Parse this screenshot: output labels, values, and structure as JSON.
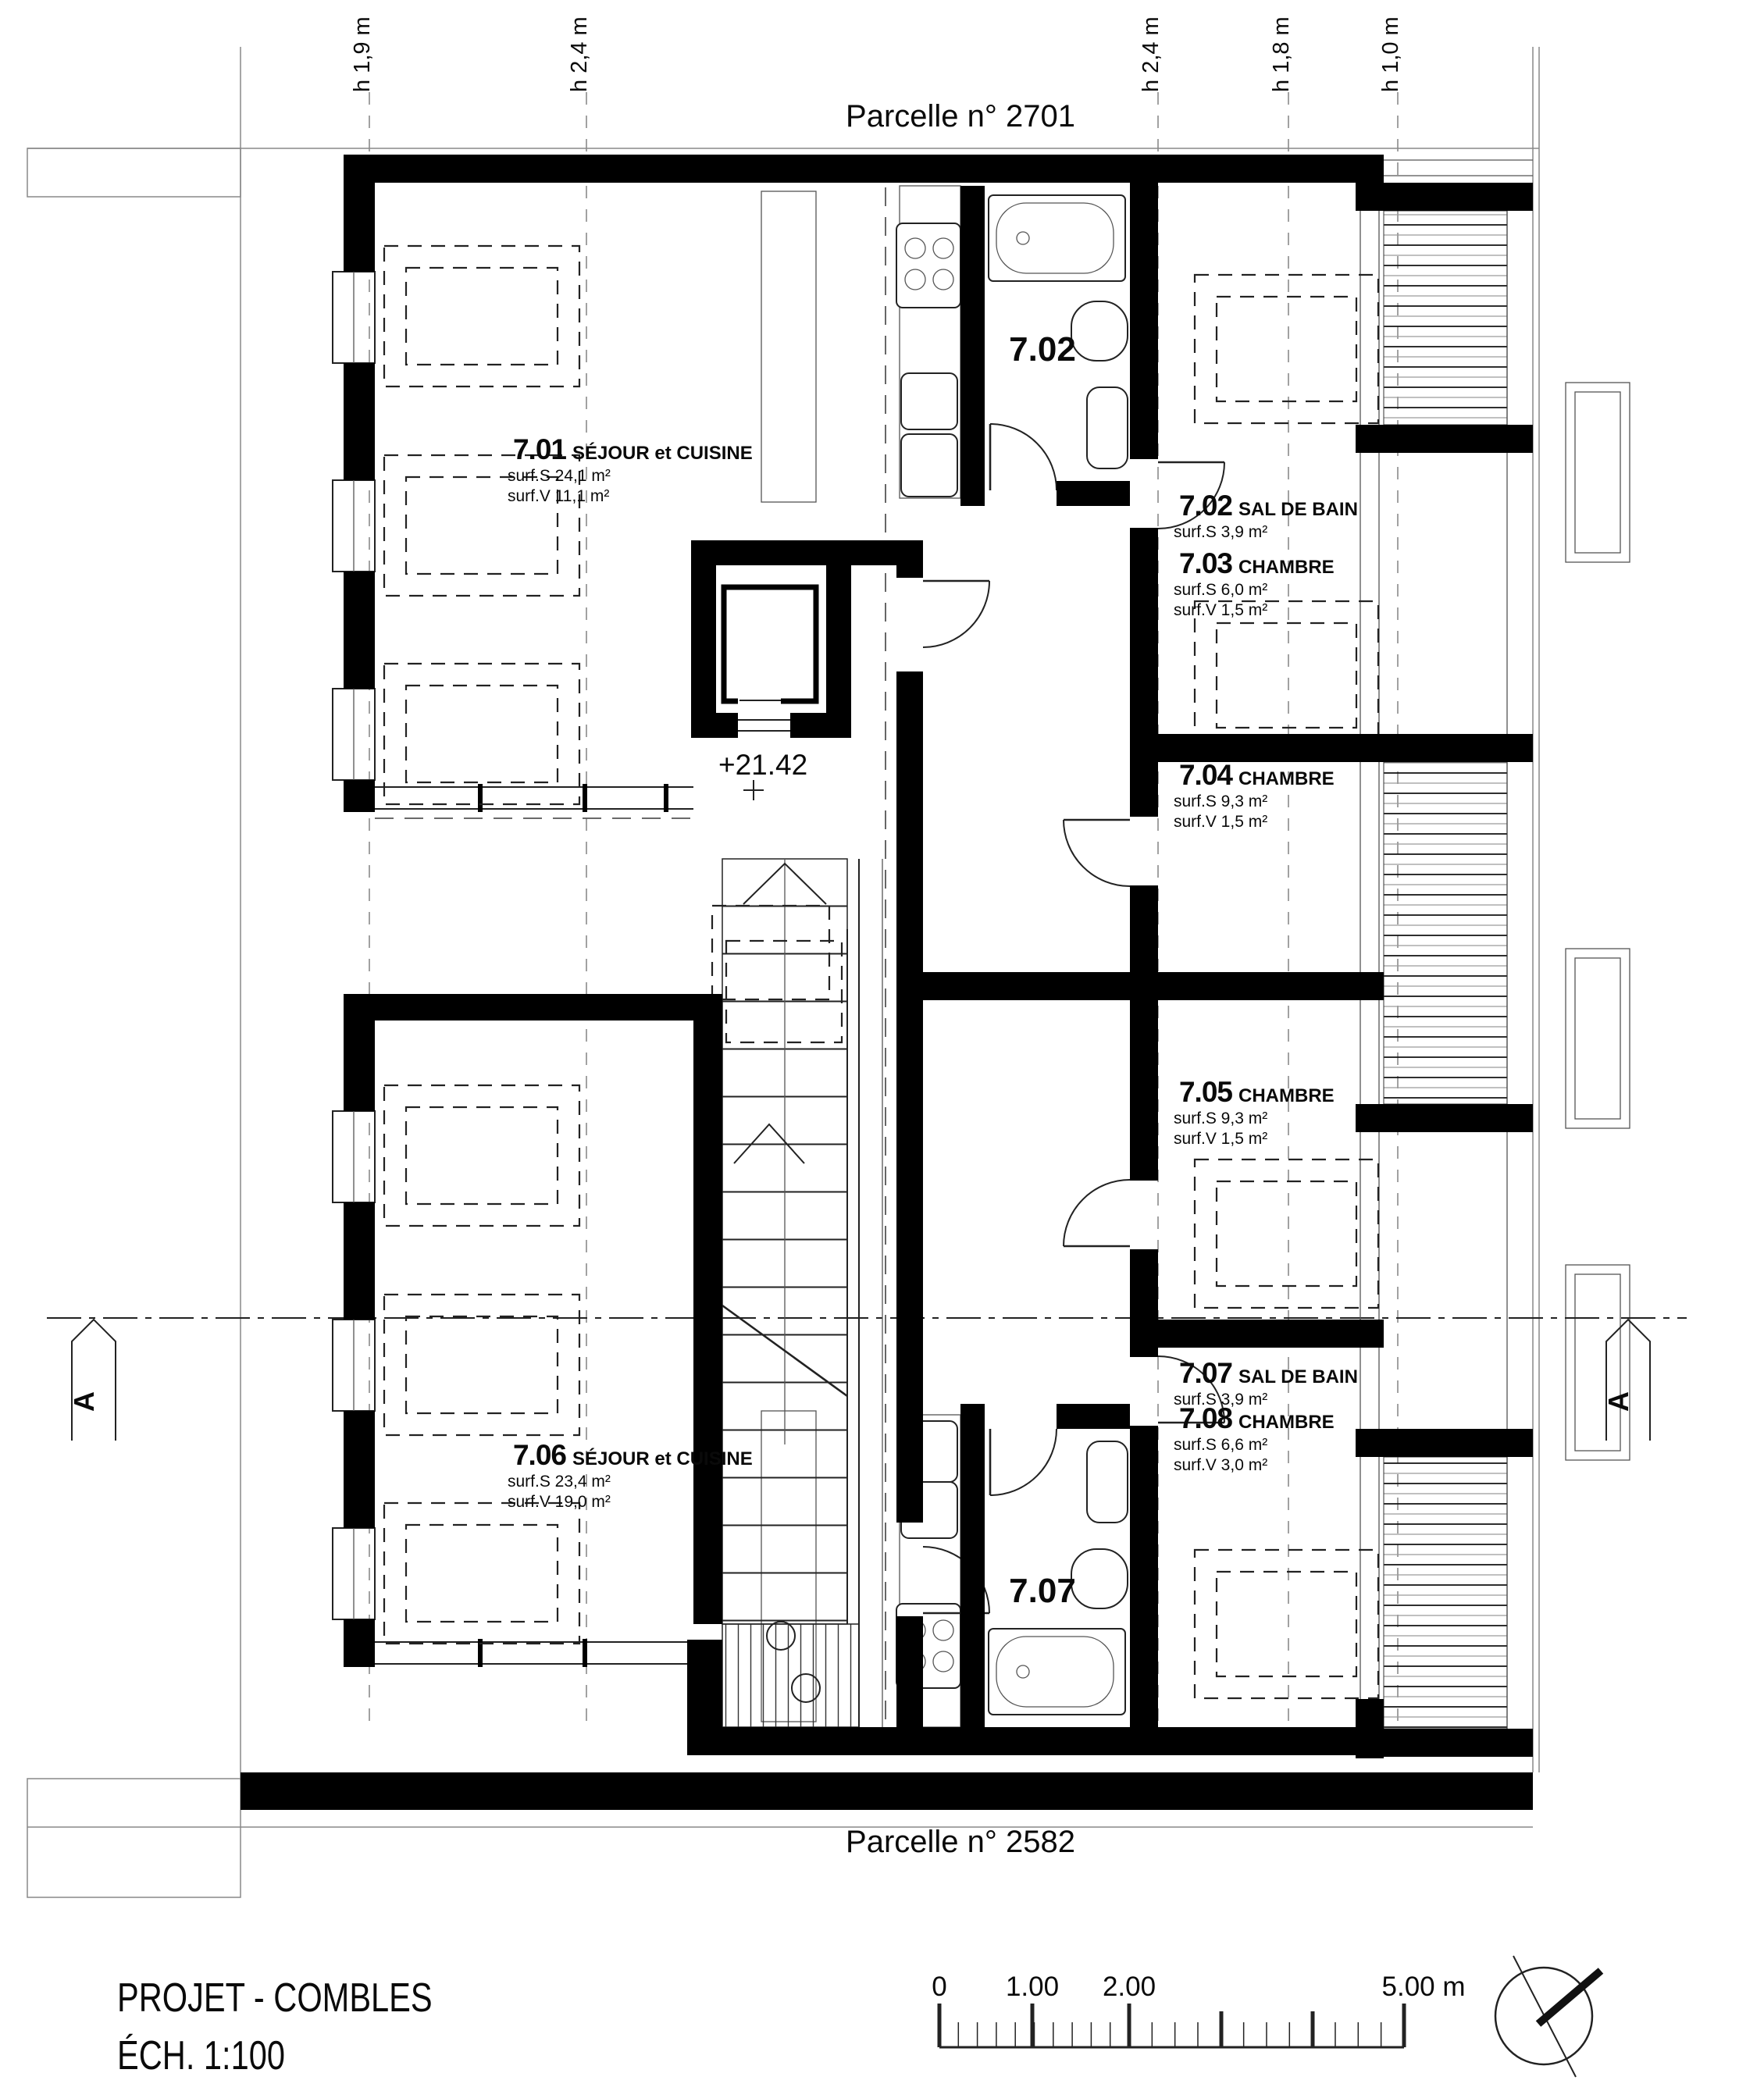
{
  "plan": {
    "parcel_top": "Parcelle n° 2701",
    "parcel_bottom": "Parcelle n° 2582",
    "level": "+21.42",
    "section_label": "A",
    "title_line1": "PROJET - COMBLES",
    "title_line2": "ÉCH. 1:100",
    "bath_tag_top": "7.02",
    "bath_tag_bottom": "7.07"
  },
  "height_labels": [
    {
      "text": "h 1,9 m"
    },
    {
      "text": "h 2,4 m"
    },
    {
      "text": "h 2,4 m"
    },
    {
      "text": "h 1,8 m"
    },
    {
      "text": "h 1,0 m"
    }
  ],
  "rooms": [
    {
      "num": "7.01",
      "name": "SÉJOUR et CUISINE",
      "s1": "surf.S 24,1 m²",
      "s2": "surf.V 11,1 m²"
    },
    {
      "num": "7.02",
      "name": "SAL DE BAIN",
      "s1": "surf.S 3,9 m²"
    },
    {
      "num": "7.03",
      "name": "CHAMBRE",
      "s1": "surf.S 6,0 m²",
      "s2": "surf.V 1,5 m²"
    },
    {
      "num": "7.04",
      "name": "CHAMBRE",
      "s1": "surf.S 9,3 m²",
      "s2": "surf.V 1,5 m²"
    },
    {
      "num": "7.05",
      "name": "CHAMBRE",
      "s1": "surf.S 9,3 m²",
      "s2": "surf.V 1,5 m²"
    },
    {
      "num": "7.06",
      "name": "SÉJOUR et CUISINE",
      "s1": "surf.S 23,4 m²",
      "s2": "surf.V 19,0 m²"
    },
    {
      "num": "7.07",
      "name": "SAL DE BAIN",
      "s1": "surf.S 3,9 m²"
    },
    {
      "num": "7.08",
      "name": "CHAMBRE",
      "s1": "surf.S 6,6 m²",
      "s2": "surf.V 3,0 m²"
    }
  ],
  "scale_bar": {
    "t0": "0",
    "t1": "1.00",
    "t2": "2.00",
    "t5": "5.00 m"
  },
  "colors": {
    "wall": "#000000",
    "line": "#222222",
    "muted": "#8a8a8a"
  }
}
